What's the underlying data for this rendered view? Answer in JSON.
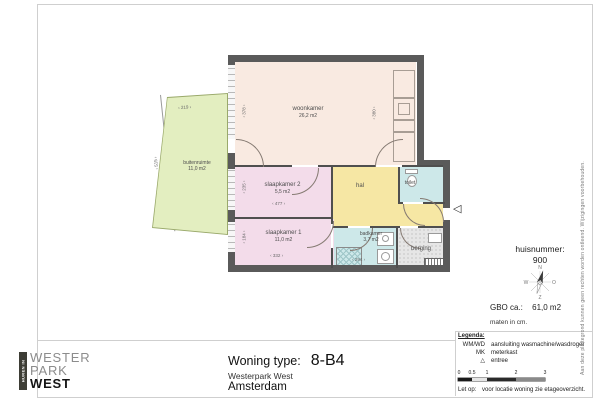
{
  "plan": {
    "rooms": [
      {
        "name": "woonkamer",
        "area": "26,2 m2"
      },
      {
        "name": "slaapkamer 2",
        "area": "5,5 m2"
      },
      {
        "name": "slaapkamer 1",
        "area": "11,0 m2"
      },
      {
        "name": "hal",
        "area": ""
      },
      {
        "name": "toilet",
        "area": ""
      },
      {
        "name": "badkamer",
        "area": "3,7 m2"
      },
      {
        "name": "berging",
        "area": ""
      },
      {
        "name": "buitenruimte",
        "area": "11,0 m2"
      }
    ],
    "dimensions": {
      "balkon_breedte": "219",
      "balkon_diepte": "515",
      "woonkamer_links": "378",
      "woonkamer_rechts": "380",
      "slaapkamer2_links": "235",
      "slaapkamer2_breedte": "477",
      "slaapkamer1_links": "184",
      "slaapkamer1_breedte": "332",
      "badkamer_breedte": "294"
    },
    "entree_icon": "◁"
  },
  "info": {
    "huisnummer_label": "huisnummer:",
    "huisnummer_value": "900",
    "gbo_label": "GBO ca.:",
    "gbo_value": "61,0 m2",
    "units_note": "maten in cm.",
    "compass": {
      "n": "N",
      "e": "O",
      "s": "Z",
      "w": "W"
    }
  },
  "legend": {
    "title": "Legenda:",
    "items": [
      {
        "key": "WM/WD",
        "label": "aansluiting wasmachine/wasdroger"
      },
      {
        "key": "MK",
        "label": "meterkast"
      },
      {
        "key": "△",
        "label": "entree"
      }
    ],
    "scale_ticks": [
      "0",
      "0.5",
      "1",
      "2",
      "3"
    ],
    "note_label": "Let op:",
    "note": "voor locatie woning zie etageoverzicht."
  },
  "title_block": {
    "type_label": "Woning type:",
    "type_value": "8-B4",
    "project": "Westerpark West",
    "city": "Amsterdam"
  },
  "logo": {
    "tagline": "HUREN IN",
    "line1": "WESTER",
    "line2": "PARK",
    "line3": "WEST"
  },
  "disclaimer": "Aan deze plattegrond kunnen geen rechten worden ontleend. Wijzigingen voorbehouden.",
  "colors": {
    "wall": "#5a5a5a",
    "woonkamer": "#f9eae1",
    "slaapkamer": "#f3dcea",
    "hal": "#f6e7a4",
    "natte_ruimte": "#cde8e9",
    "berging": "#e6e6e6",
    "buitenruimte": "#e3eec0",
    "logo_bar": "#3d3d35"
  }
}
